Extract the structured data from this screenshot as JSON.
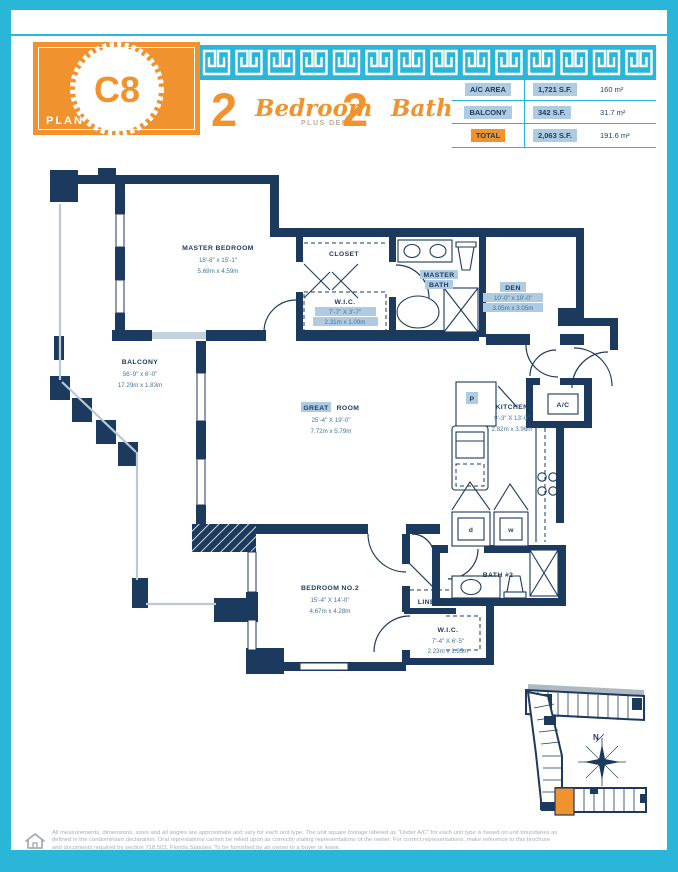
{
  "header": {
    "plan_word": "PLAN",
    "plan_code": "C8",
    "bed_count": "2",
    "bed_label": "Bedroom",
    "bed_sub": "PLUS DEN",
    "bath_count": "2",
    "bath_label": "Bath",
    "table": {
      "rows": [
        {
          "label": "A/C AREA",
          "sf": "1,721 S.F.",
          "metric": "160 m²"
        },
        {
          "label": "BALCONY",
          "sf": "342 S.F.",
          "metric": "31.7 m²"
        },
        {
          "label": "TOTAL",
          "sf": "2,063 S.F.",
          "metric": "191.6 m²"
        }
      ]
    }
  },
  "floorplan": {
    "master_bedroom": {
      "name": "MASTER BEDROOM",
      "ft": "18'-8\" x 15'-1\"",
      "m": "5.69m x 4.59m"
    },
    "balcony": {
      "name": "BALCONY",
      "ft": "56'-9\" x 6'-0\"",
      "m": "17.29m x 1.83m"
    },
    "closet": {
      "name": "CLOSET"
    },
    "wic1": {
      "name": "W.I.C.",
      "ft": "7'-7\" X 3'-7\"",
      "m": "2.31m x 1.09m"
    },
    "master_bath": {
      "line1": "MASTER",
      "line2": "BATH"
    },
    "den": {
      "name": "DEN",
      "ft": "10'-0\" x 10'-0\"",
      "m": "3.05m x 3.05m"
    },
    "great_room": {
      "word1": "GREAT",
      "word2": "ROOM",
      "ft": "25'-4\" X 19'-0\"",
      "m": "7.72m x 5.79m"
    },
    "kitchen": {
      "name": "KITCHEN",
      "ft": "9'-3\" X 13'-0\"",
      "m": "2.82m x 3.96m"
    },
    "pantry": {
      "name": "P"
    },
    "ac_closet": {
      "name": "A/C"
    },
    "dryer": {
      "name": "d"
    },
    "washer": {
      "name": "w"
    },
    "bath2": {
      "name": "BATH #2"
    },
    "linen": {
      "name": "LINEN"
    },
    "bedroom2": {
      "name": "BEDROOM NO.2",
      "ft": "15'-4\" X 14'-0\"",
      "m": "4.67m x 4.28m"
    },
    "wic2": {
      "name": "W.I.C.",
      "ft": "7'-4\" X 6'-5\"",
      "m": "2.23m x 1.95m"
    }
  },
  "siteplan": {
    "north": "N"
  },
  "footer": {
    "line1": "All measurements, dimensions, sizes and all angles are approximate and vary for each unit type. The unit square footage labeled as \"Under A/C\" for each unit type is based on unit boundaries as",
    "line2": "defined in the condominium declaration. Oral represtations cannot be relied upon as correctly stating representations of the owner. For correct representations, make reference to this brochure",
    "line3": "and documents required by section 718.503, Florida Statutes. To be furnished by an owner to a buyer or lesee."
  },
  "colors": {
    "cyan": "#29b6d8",
    "orange": "#f0932f",
    "navy": "#1c3a5e",
    "chip": "#aecbe2"
  }
}
